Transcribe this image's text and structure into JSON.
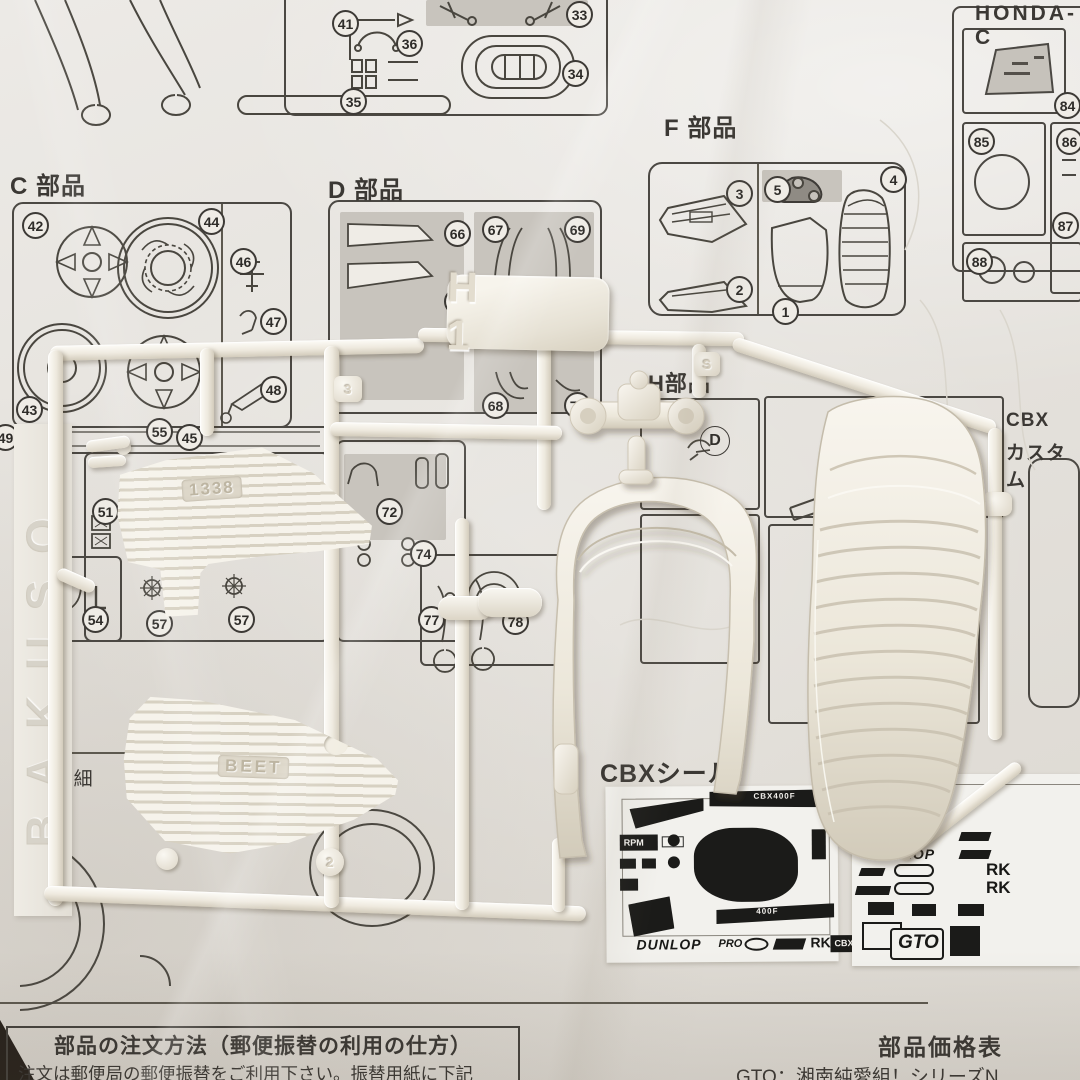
{
  "labels": {
    "honda_header": "HONDA-C",
    "c_parts": "C 部品",
    "d_parts": "D 部品",
    "f_parts": "F 部品",
    "h_parts": "H部品",
    "cbx_line1": "CBX",
    "cbx_line2": "カスタム",
    "seal_title": "CBXシール",
    "left_note": "2個（細",
    "circled_d": "D"
  },
  "callouts": {
    "top_mid": [
      "41",
      "36",
      "35",
      "33",
      "34"
    ],
    "honda": [
      "84",
      "85",
      "86",
      "87",
      "88"
    ],
    "f": [
      "3",
      "2",
      "5",
      "4",
      "1"
    ],
    "c": [
      "42",
      "44",
      "46",
      "47",
      "48",
      "43",
      "49",
      "55",
      "45"
    ],
    "d": [
      "66",
      "65",
      "67",
      "69",
      "68",
      "70"
    ],
    "left_mid": [
      "51",
      "53",
      "54",
      "57",
      "57"
    ],
    "center_mid": [
      "72",
      "74",
      "77",
      "78"
    ]
  },
  "molded_text": {
    "tag": "H 1",
    "cover_a": "1338",
    "cover_b": "BEET",
    "brand": "BAKUSO",
    "gate_a": "3",
    "gate_b": "2",
    "gate_c": "S"
  },
  "decals": {
    "cbx_sheet": {
      "rpm": "RPM",
      "stripe_top": "CBX400F",
      "stripe_bottom": "400F",
      "dunlop": "DUNLOP",
      "pro": "PRO",
      "rk": "RK",
      "badge": "CBX400F"
    },
    "logo_sheet": {
      "dunlop_1": "DUNLOP",
      "dunlop_2": "DUNLOP",
      "rk_1": "RK",
      "rk_2": "RK",
      "gto": "GTO"
    }
  },
  "footer": {
    "order_title": "部品の注文方法（郵便振替の利用の仕方）",
    "order_line1": "注文は郵便局の郵便振替をご利用下さい。振替用紙に下記",
    "order_line2": "事項を必ずご記入の上、代金をお払込み下さい。",
    "price_title": "部品価格表",
    "series_line": "GTO：湘南純愛組！シリーズN"
  }
}
